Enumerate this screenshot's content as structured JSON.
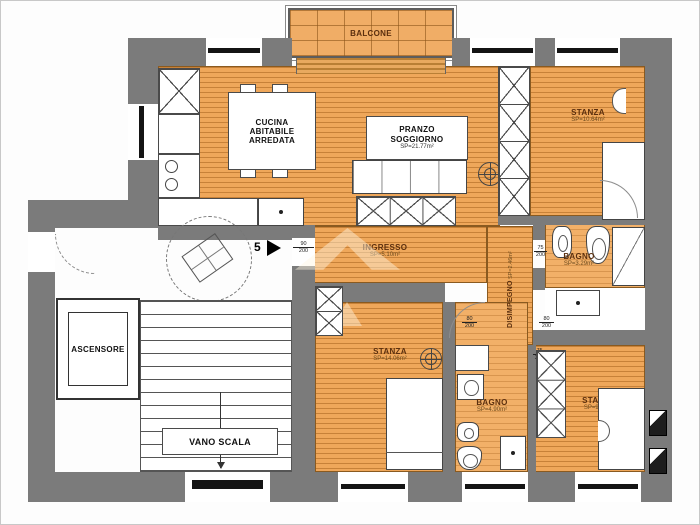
{
  "rooms": {
    "balcone": {
      "label": "BALCONE"
    },
    "cucina": {
      "label": "CUCINA ABITABILE ARREDATA"
    },
    "pranzo": {
      "label": "PRANZO SOGGIORNO",
      "area": "SP=21.77m²"
    },
    "stanza_top_right": {
      "label": "STANZA",
      "area": "SP=10.64m²"
    },
    "ingresso": {
      "label": "INGRESSO",
      "area": "SP=5.10m²"
    },
    "bagno_top": {
      "label": "BAGNO",
      "area": "SP=3.29m²"
    },
    "disimpegno": {
      "label": "DISIMPEGNO",
      "area": "SP=2.46m²"
    },
    "stanza_center": {
      "label": "STANZA",
      "area": "SP=14.06m²"
    },
    "bagno_bottom": {
      "label": "BAGNO",
      "area": "SP=4.90m²"
    },
    "stanza_right": {
      "label": "STANZA",
      "area": "SP=9.62m²"
    },
    "ascensore": {
      "label": "ASCENSORE"
    },
    "vano_scala": {
      "label": "VANO SCALA"
    }
  },
  "unit": {
    "number": "5"
  },
  "door_dims": {
    "entry": {
      "w": "90",
      "h": "200"
    },
    "bagno_top": {
      "w": "75",
      "h": "200"
    },
    "stanza_center": {
      "w": "80",
      "h": "200"
    },
    "stanza_right": {
      "w": "80",
      "h": "200"
    },
    "bagno_bottom": {
      "w": "75",
      "h": "200"
    }
  },
  "colors": {
    "wall": "#7b7b7b",
    "floor": "#efa75a",
    "floor_line": "#b06720",
    "room_label": "#5b2f0e"
  }
}
